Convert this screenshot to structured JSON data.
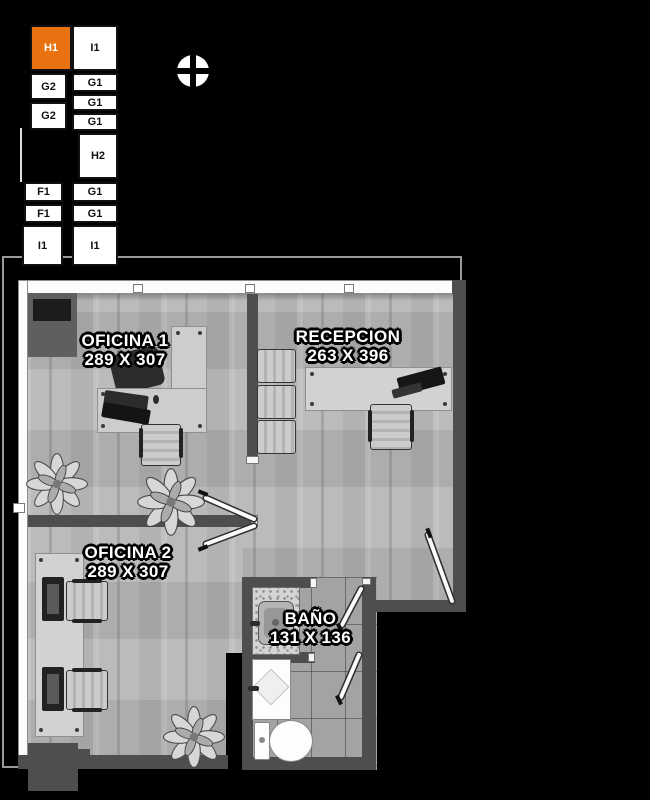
{
  "keyplan": {
    "highlight_color": "#e8720f",
    "cells": [
      {
        "label": "H1",
        "highlighted": true
      },
      {
        "label": "I1",
        "highlighted": false
      },
      {
        "label": "G2",
        "highlighted": false
      },
      {
        "label": "G1",
        "highlighted": false
      },
      {
        "label": "G2",
        "highlighted": false
      },
      {
        "label": "G1",
        "highlighted": false
      },
      {
        "label": "G1",
        "highlighted": false
      },
      {
        "label": "H2",
        "highlighted": false
      },
      {
        "label": "F1",
        "highlighted": false
      },
      {
        "label": "G1",
        "highlighted": false
      },
      {
        "label": "F1",
        "highlighted": false
      },
      {
        "label": "G1",
        "highlighted": false
      },
      {
        "label": "I1",
        "highlighted": false
      },
      {
        "label": "I1",
        "highlighted": false
      }
    ]
  },
  "rooms": {
    "oficina1": {
      "name": "OFICINA 1",
      "dims": "289 X 307"
    },
    "recepcion": {
      "name": "RECEPCION",
      "dims": "263 X 396"
    },
    "oficina2": {
      "name": "OFICINA 2",
      "dims": "289 X 307"
    },
    "bano": {
      "name": "BAÑO",
      "dims": "131 X 136"
    }
  },
  "icons": {
    "compass": "north-orientation-marker"
  },
  "colors": {
    "background": "#000000",
    "unit_highlight": "#e8720f",
    "wall_dark": "#4e4e4e",
    "window_wall": "#fcfcfc"
  }
}
